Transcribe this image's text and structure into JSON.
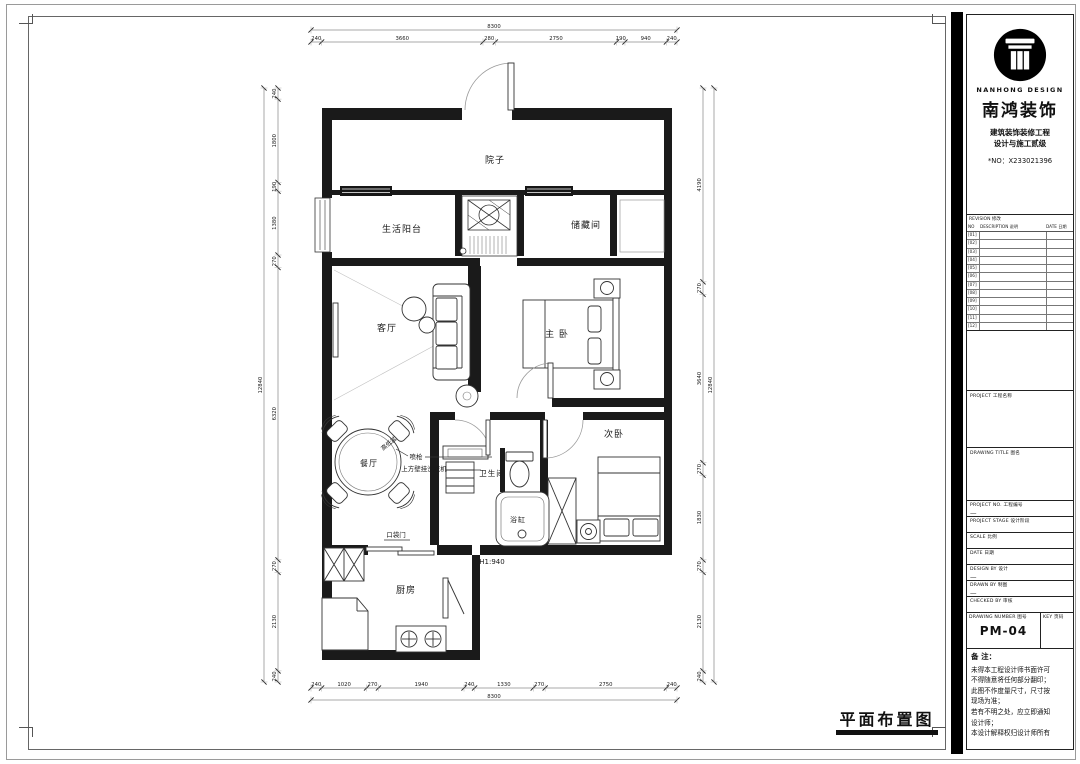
{
  "page": {
    "drawing_title": "平面布置图"
  },
  "titleblock": {
    "brand": {
      "company_en": "NANHONG DESIGN",
      "company_cn": "南鸿装饰",
      "cert_line1": "建筑装饰装修工程",
      "cert_line2": "设计与施工贰级",
      "cert_no": "*NO：X233021396"
    },
    "revision": {
      "title": "REVISION 修改",
      "col_no": "NO",
      "col_desc": "DESCRIPTION 说明",
      "col_date": "DATE 日期",
      "rows": [
        "[01]",
        "[02]",
        "[03]",
        "[04]",
        "[05]",
        "[06]",
        "[07]",
        "[08]",
        "[09]",
        "[10]",
        "[11]",
        "[12]"
      ]
    },
    "fields": [
      {
        "label": "PROJECT 工程名称",
        "value": ""
      },
      {
        "label": "DRAWING TITLE 图名",
        "value": ""
      },
      {
        "label": "PROJECT NO. 工程编号",
        "value": "—"
      },
      {
        "label": "PROJECT STAGE 设计阶段",
        "value": ""
      },
      {
        "label": "SCALE 比例",
        "value": ""
      },
      {
        "label": "DATE 日期",
        "value": ""
      },
      {
        "label": "DESIGN BY 设计",
        "value": "—"
      },
      {
        "label": "DRAWN BY 制图",
        "value": "—"
      },
      {
        "label": "CHECKED BY 审核",
        "value": ""
      }
    ],
    "drawing_number": {
      "label": "DRAWING NUMBER 图号",
      "value": "PM-04",
      "key_label": "KEY 页码",
      "key_value": ""
    },
    "notes": {
      "title": "备 注：",
      "lines": [
        "未得本工程设计师书面许可",
        "不得随意将任何部分翻印；",
        "此图不作度量尺寸，尺寸按",
        "现场为准；",
        "若有不明之处，应立即通知",
        "设计师；",
        "本设计解释权归设计师所有"
      ]
    }
  },
  "plan": {
    "rooms": [
      {
        "id": "courtyard",
        "label": "院子",
        "x": 495,
        "y": 163,
        "size": 9
      },
      {
        "id": "service-balcony",
        "label": "生活阳台",
        "x": 402,
        "y": 232,
        "size": 9
      },
      {
        "id": "storage",
        "label": "储藏间",
        "x": 586,
        "y": 228,
        "size": 9
      },
      {
        "id": "living-room",
        "label": "客厅",
        "x": 387,
        "y": 331,
        "size": 9
      },
      {
        "id": "master-bedroom",
        "label": "主 卧",
        "x": 557,
        "y": 337,
        "size": 9
      },
      {
        "id": "second-bedroom",
        "label": "次卧",
        "x": 614,
        "y": 437,
        "size": 9
      },
      {
        "id": "dining-room",
        "label": "餐厅",
        "x": 369,
        "y": 466,
        "size": 8
      },
      {
        "id": "bathroom",
        "label": "卫生间",
        "x": 492,
        "y": 476,
        "size": 7.5
      },
      {
        "id": "bathtub",
        "label": "浴缸",
        "x": 518,
        "y": 522,
        "size": 7
      },
      {
        "id": "kitchen",
        "label": "厨房",
        "x": 406,
        "y": 593,
        "size": 9
      }
    ],
    "annotations": [
      {
        "id": "sprayer",
        "label": "喷枪",
        "x": 416,
        "y": 459,
        "size": 6.5
      },
      {
        "id": "wall-washer",
        "label": "上方壁挂洗衣机",
        "x": 424,
        "y": 471,
        "size": 6.5
      },
      {
        "id": "hi-lo-basin",
        "label": "高低盆",
        "x": 390,
        "y": 445,
        "size": 6,
        "rot": -40
      },
      {
        "id": "pocket-door",
        "label": "口袋门",
        "x": 396,
        "y": 537,
        "size": 6.5
      },
      {
        "id": "wall-height",
        "label": "H1:940",
        "x": 492,
        "y": 564,
        "size": 7
      }
    ],
    "dimensions": {
      "top": {
        "overall": 8300,
        "segments": [
          240,
          3660,
          280,
          2750,
          190,
          940,
          240
        ]
      },
      "bottom": {
        "overall": 8300,
        "segments": [
          240,
          1020,
          270,
          1940,
          240,
          1330,
          270,
          2750,
          240
        ]
      },
      "left": {
        "overall": 12840,
        "segments": [
          240,
          1800,
          190,
          1380,
          270,
          6320,
          270,
          2130,
          240
        ]
      },
      "right": {
        "overall": 12840,
        "segments": [
          4190,
          270,
          3640,
          270,
          1830,
          270,
          2130,
          240
        ]
      }
    }
  }
}
